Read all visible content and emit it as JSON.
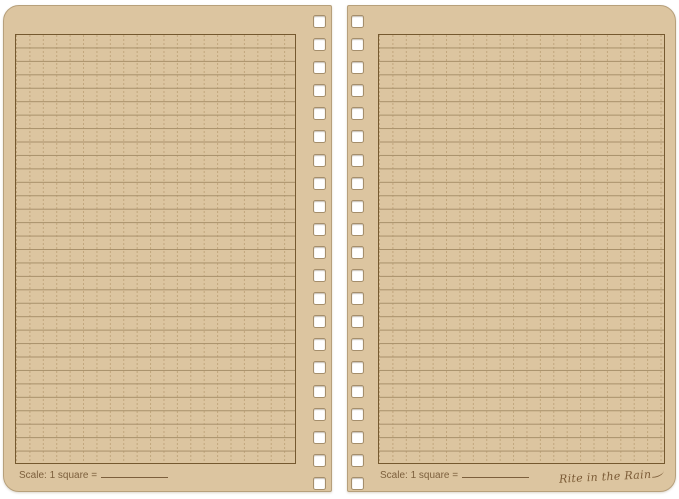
{
  "theme": {
    "background": "#ffffff",
    "page": "#dcc5a0",
    "page_edge": "#b7a07b",
    "rule_line": "#a8906a",
    "grid_dash": "#c1a67c",
    "box_border": "#75592f",
    "ink": "#7c5f3c",
    "hole_border": "#a58e6b",
    "hole_fill": "#ffffff",
    "signature_ink": "#7a5a35"
  },
  "notebook": {
    "holes_per_page": 21,
    "grid_rows": 32,
    "grid_columns": 21,
    "left_page": {
      "scale_label": "Scale: 1 square =",
      "scale_value": ""
    },
    "right_page": {
      "scale_label": "Scale: 1 square =",
      "scale_value": "",
      "brand_signature": "Rite in the Rain"
    }
  }
}
